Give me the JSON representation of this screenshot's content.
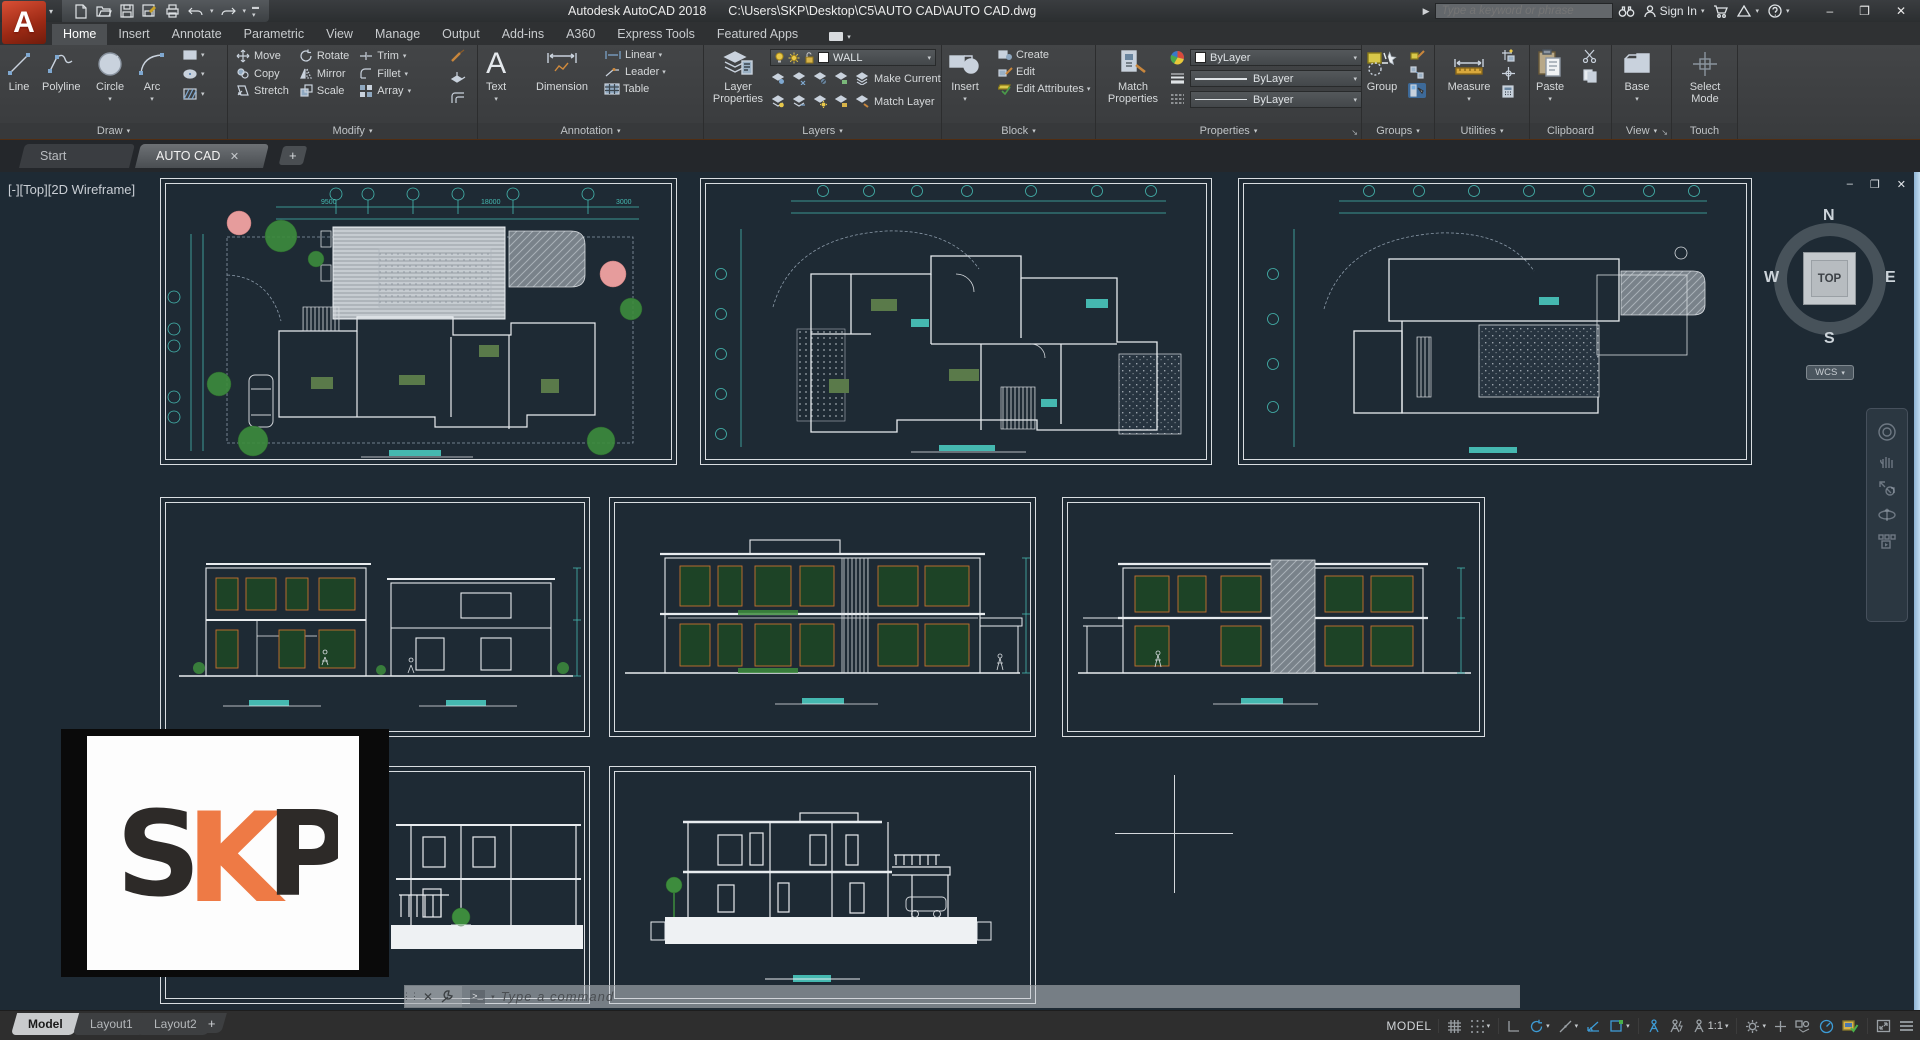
{
  "window": {
    "app_title": "Autodesk AutoCAD 2018",
    "file_path": "C:\\Users\\SKP\\Desktop\\C5\\AUTO CAD\\AUTO CAD.dwg",
    "minimize": "–",
    "restore": "❐",
    "close": "✕"
  },
  "titlebar": {
    "search_placeholder": "Type a keyword or phrase",
    "sign_in": "Sign In"
  },
  "ribbon": {
    "tabs": [
      "Home",
      "Insert",
      "Annotate",
      "Parametric",
      "View",
      "Manage",
      "Output",
      "Add-ins",
      "A360",
      "Express Tools",
      "Featured Apps"
    ],
    "draw": {
      "label": "Draw",
      "items": [
        "Line",
        "Polyline",
        "Circle",
        "Arc"
      ]
    },
    "modify": {
      "label": "Modify",
      "items": [
        "Move",
        "Rotate",
        "Trim",
        "Copy",
        "Mirror",
        "Fillet",
        "Stretch",
        "Scale",
        "Array"
      ]
    },
    "annotation": {
      "label": "Annotation",
      "items": [
        "Text",
        "Dimension",
        "Linear",
        "Leader",
        "Table"
      ]
    },
    "layers": {
      "label": "Layers",
      "current_layer": "WALL",
      "items": [
        "Layer Properties",
        "Make Current",
        "Match Layer"
      ]
    },
    "block": {
      "label": "Block",
      "items": [
        "Insert",
        "Create",
        "Edit",
        "Edit Attributes"
      ]
    },
    "properties": {
      "label": "Properties",
      "items": [
        "Match Properties"
      ],
      "object_color": "ByLayer",
      "lineweight": "ByLayer",
      "linetype": "ByLayer"
    },
    "groups": {
      "label": "Groups",
      "items": [
        "Group"
      ]
    },
    "utilities": {
      "label": "Utilities",
      "items": [
        "Measure"
      ]
    },
    "clipboard": {
      "label": "Clipboard",
      "items": [
        "Paste"
      ]
    },
    "view": {
      "label": "View",
      "items": [
        "Base"
      ]
    },
    "touch": {
      "label": "Touch",
      "items": [
        "Select Mode"
      ]
    }
  },
  "file_tabs": {
    "start": "Start",
    "drawing": "AUTO CAD",
    "close": "✕",
    "add": "+"
  },
  "canvas": {
    "viewport_label": "[-][Top][2D Wireframe]",
    "viewcube": {
      "n": "N",
      "e": "E",
      "s": "S",
      "w": "W",
      "face": "TOP",
      "wcs": "WCS"
    },
    "command_prompt": "Type a command",
    "frame1_dims": {
      "d1": "9500",
      "d2": "18000",
      "d3": "3000"
    }
  },
  "statusbar": {
    "model_tab": "Model",
    "layout1": "Layout1",
    "layout2": "Layout2",
    "add": "+",
    "space": "MODEL",
    "annotation_scale": "1:1"
  },
  "logo": {
    "l1": "S",
    "l2": "K",
    "l3": "P"
  },
  "colors": {
    "accent_teal": "#45b8b0",
    "tree_green": "#3d8c3d",
    "flower_pink": "#e69c9c",
    "logo_orange": "#ee7a45",
    "logo_dark": "#2d2a28",
    "status_blue": "#3d9bd5",
    "canvas_bg": "#1e2a34",
    "window_green": "#1d4326",
    "frame_orange": "#c8722e"
  }
}
